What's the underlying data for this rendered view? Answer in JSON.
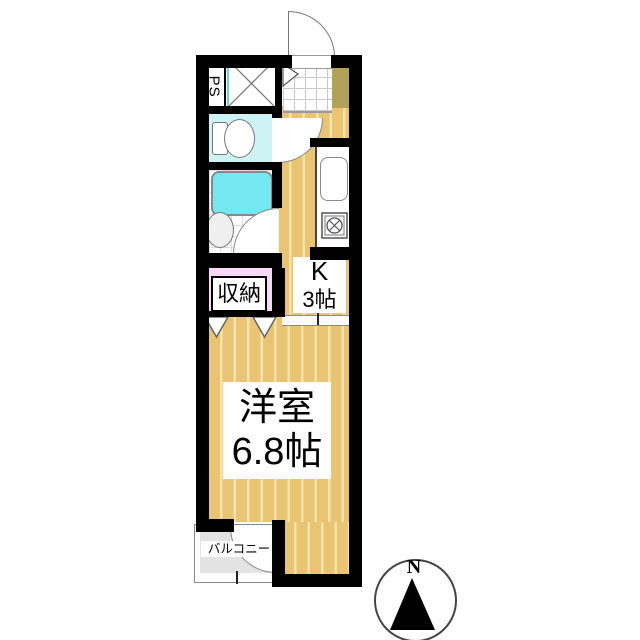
{
  "floorplan": {
    "rooms": {
      "western_room": {
        "name": "洋室",
        "size": "6.8帖"
      },
      "kitchen": {
        "name": "K",
        "size": "3帖"
      },
      "closet": {
        "name": "収納"
      },
      "balcony": {
        "name": "バルコニー"
      },
      "pipe_space": {
        "name": "PS"
      }
    },
    "compass": {
      "north_label": "N"
    },
    "colors": {
      "wall": "#000000",
      "wood_floor": "#e9c472",
      "wood_floor_stripe": "#f5e3ac",
      "entrance_tile_line": "#c9c9c9",
      "toilet_floor": "#cdf3f2",
      "bathtub": "#74e8f0",
      "closet_floor": "#f8d8f7",
      "balcony_floor": "#e3e3e3",
      "shoe_cabinet": "#b1a257",
      "washer_pan_accent": "#5fd8e0"
    },
    "fixtures": [
      "entrance-door-swing",
      "entrance-direction-arrow",
      "washing-machine-space",
      "shoe-cabinet",
      "toilet",
      "bathtub",
      "washbasin",
      "kitchen-sink",
      "gas-stove",
      "folding-closet-doors",
      "toilet-door-swing",
      "bathroom-door-swing",
      "balcony-door-swing",
      "north-compass"
    ]
  }
}
